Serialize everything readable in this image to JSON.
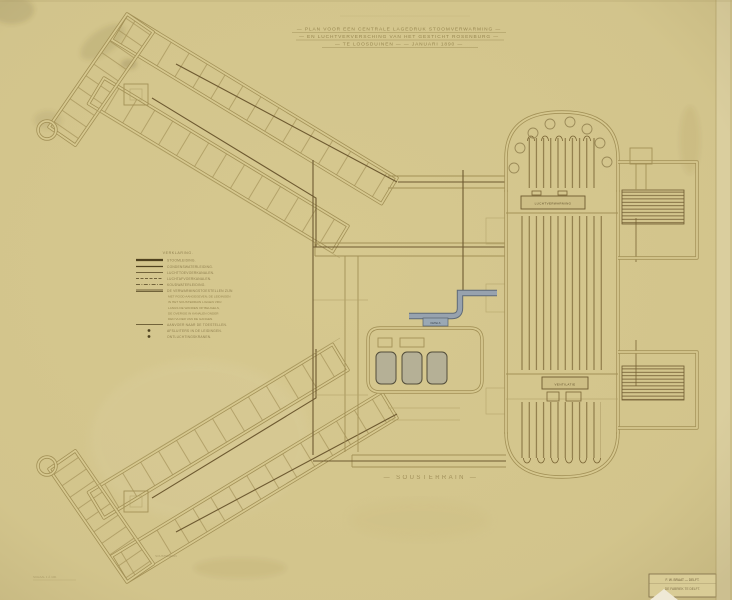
{
  "document": {
    "title_lines": [
      "— PLAN VOOR EEN CENTRALE LAGEDRUK STOOMVERWARMING —",
      "— EN LUCHTVERVERSCHING VAN HET GESTICHT ROSENBURG —",
      "— TE LOOSDUINEN —            — JANUARI 1890 —"
    ],
    "floor_label": "— SOUSTERRAIN —",
    "wing_room_label": "SOUSTERRAIN",
    "scale_note": "SCHAAL 1 À 100."
  },
  "legend": {
    "header": "VERKLARING.",
    "items": [
      {
        "style": "thick",
        "label": "STOOMLEIDING."
      },
      {
        "style": "solid",
        "label": "CONDENSWATERLEIDING."
      },
      {
        "style": "thin",
        "label": "LUCHTTOEVOERKANALEN."
      },
      {
        "style": "dashed",
        "label": "LUCHTAFVOERKANALEN."
      },
      {
        "style": "dashdot",
        "label": "KOUDWATERLEIDING."
      },
      {
        "style": "double",
        "label": "DE VERWARMINGSTOESTELLEN ZIJN"
      },
      {
        "style": "thin",
        "label": "AANVOER NAAR DE TOESTELLEN."
      },
      {
        "style": "dot",
        "label": "AFSLUITERS IN DE LEIDINGEN."
      },
      {
        "style": "dot",
        "label": "ONTLUCHTINGSKRANEN."
      }
    ],
    "note_lines": [
      "MET ROOD AANGEGEVEN; DE LEIDINGEN",
      "IN HET SOUSTERRAIN LIGGEN VRIJ",
      "LANGS DE WANDEN OP BEUGELS,",
      "DE OVERIGE IN KANALEN ONDER",
      "DEN VLOER VAN DE GANGEN."
    ]
  },
  "plan_labels": {
    "hall_upper": "LUCHTVERWARMING",
    "hall_lower": "VENTILATIE",
    "boiler_room": "KETELS"
  },
  "signature": {
    "line1": "F. W. BRAAT — DELFT.",
    "line2": "DE FABRIEK TE DELFT."
  },
  "colors": {
    "paper": "#d6c88f",
    "wall": "#a39157",
    "pipe": "#6e5a31",
    "steel_pipe": "#8c97a3",
    "label_accent": "#9aa8b4"
  }
}
